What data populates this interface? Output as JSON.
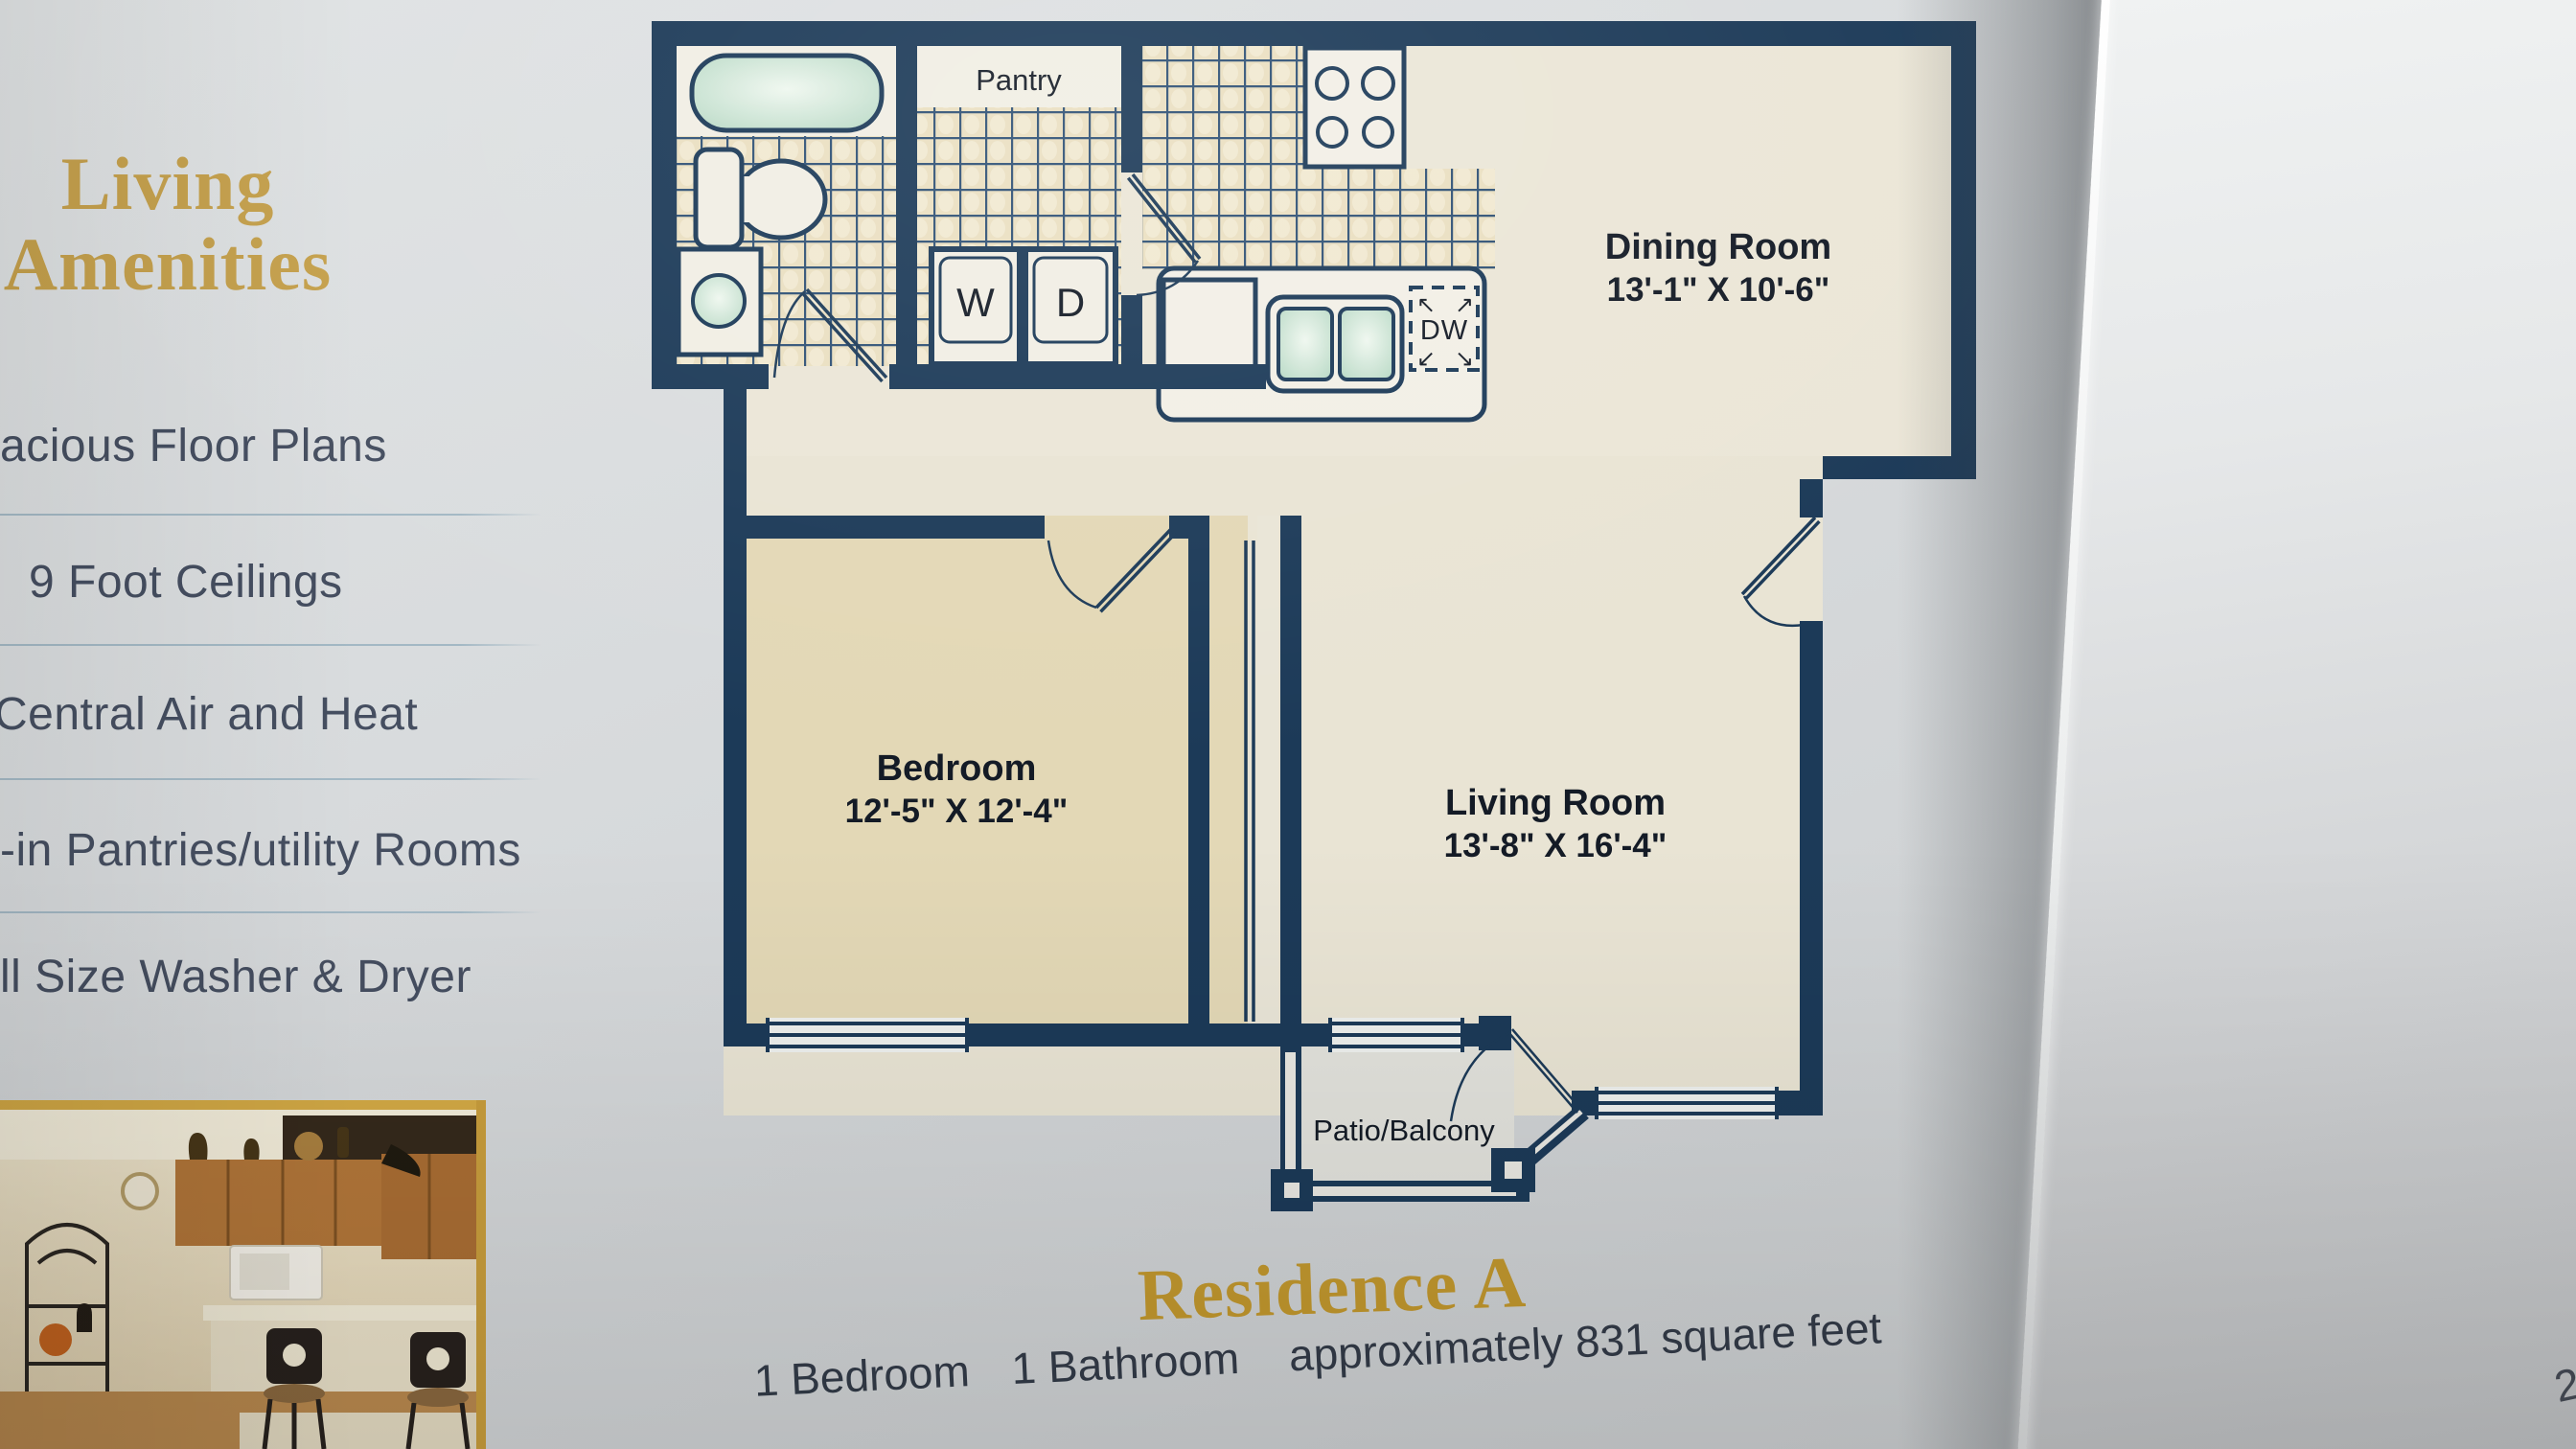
{
  "page": {
    "page_number": "2"
  },
  "sidebar": {
    "heading_line1": "Living",
    "heading_line2": "Amenities",
    "items": [
      {
        "label": "acious Floor Plans"
      },
      {
        "label": "9 Foot Ceilings"
      },
      {
        "label": "Central Air and Heat"
      },
      {
        "label": "-in Pantries/utility Rooms"
      },
      {
        "label": "ll Size Washer & Dryer"
      }
    ]
  },
  "floorplan": {
    "rooms": {
      "pantry": {
        "label": "Pantry"
      },
      "dining": {
        "label": "Dining Room",
        "dimensions": "13'-1\" X 10'-6\""
      },
      "bedroom": {
        "label": "Bedroom",
        "dimensions": "12'-5\" X 12'-4\""
      },
      "living": {
        "label": "Living Room",
        "dimensions": "13'-8\" X 16'-4\""
      },
      "patio": {
        "label": "Patio/Balcony"
      }
    },
    "appliances": {
      "washer_label": "W",
      "dryer_label": "D",
      "dishwasher_label": "DW"
    }
  },
  "footer": {
    "title": "Residence A",
    "bedrooms": "1 Bedroom",
    "bathrooms": "1 Bathroom",
    "area": "approximately 831 square feet"
  },
  "colors": {
    "accent_gold": "#c5a04b",
    "wall_navy": "#1c3a58",
    "tile_tan": "#eadfc1",
    "bedroom_tan": "#e3d9b8",
    "fixture_green": "#bfdcc9",
    "sidebar_text": "#454e60",
    "page_background": "#d8dbdd"
  }
}
